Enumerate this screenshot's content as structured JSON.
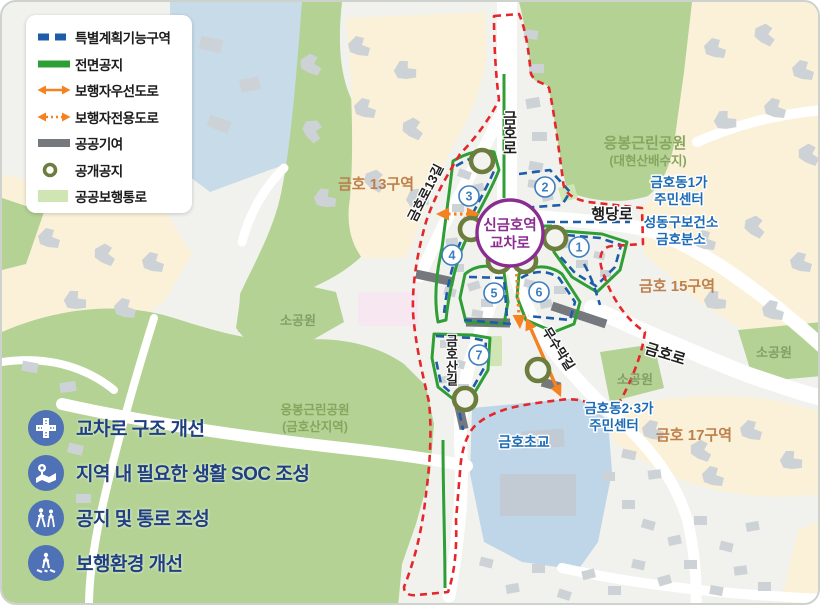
{
  "legend": {
    "items": [
      {
        "label": "특별계획기능구역",
        "swatch": "dashed-line",
        "color": "#1d5ca8"
      },
      {
        "label": "전면공지",
        "swatch": "solid-line",
        "color": "#2f9e36"
      },
      {
        "label": "보행자우선도로",
        "swatch": "double-arrow-solid",
        "color": "#f58220"
      },
      {
        "label": "보행자전용도로",
        "swatch": "double-arrow-dotted",
        "color": "#f58220"
      },
      {
        "label": "공공기여",
        "swatch": "thick-line",
        "color": "#75797d"
      },
      {
        "label": "공개공지",
        "swatch": "ring",
        "color": "#6c7d3e"
      },
      {
        "label": "공공보행통로",
        "swatch": "fill",
        "color": "#cfe6b4"
      }
    ]
  },
  "goals": {
    "items": [
      {
        "label": "교차로 구조 개선",
        "icon": "intersection-icon"
      },
      {
        "label": "지역 내 필요한 생활 SOC 조성",
        "icon": "map-pin-icon"
      },
      {
        "label": "공지 및 통로 조성",
        "icon": "people-walking-icon"
      },
      {
        "label": "보행환경 개선",
        "icon": "pedestrian-crossing-icon"
      }
    ]
  },
  "map": {
    "station": {
      "line1": "신금호역",
      "line2": "교차로"
    },
    "zone_numbers": [
      "1",
      "2",
      "3",
      "4",
      "5",
      "6",
      "7"
    ],
    "roads": {
      "geumho_ro_top": "금호로",
      "haengdang_ro": "행당로",
      "geumho_ro_13gil": "금호로13길",
      "geumho_san_gil": "금호산길",
      "musumak_gil": "무수막길",
      "geumho_ro_se": "금호로"
    },
    "places": {
      "park_ne_line1": "응봉근린공원",
      "park_ne_line2": "(대현산배수지)",
      "district_13": "금호 13구역",
      "district_15": "금호 15구역",
      "district_17": "금호 17구역",
      "center_1ga_line1": "금호동1가",
      "center_1ga_line2": "주민센터",
      "health_center_line1": "성동구보건소",
      "health_center_line2": "금호분소",
      "small_park_left": "소공원",
      "small_park_mid": "소공원",
      "small_park_right": "소공원",
      "park_sw_line1": "응봉근린공원",
      "park_sw_line2": "(금호산지역)",
      "school": "금호초교",
      "center_23ga_line1": "금호동2·3가",
      "center_23ga_line2": "주민센터"
    },
    "colors": {
      "boundary_red": "#e5262a",
      "special_plan_blue": "#1d5ca8",
      "frontage_green": "#2f9e36",
      "pedestrian_orange": "#f58220",
      "contribution_gray": "#75797d",
      "open_space_olive": "#6c7d3e",
      "walkway_lightgreen": "#cfe6b4",
      "station_purple": "#8b2c90",
      "park_green": "#b3d293",
      "zone_cream": "#faf1d8",
      "school_blue": "#bfd6e8"
    }
  }
}
